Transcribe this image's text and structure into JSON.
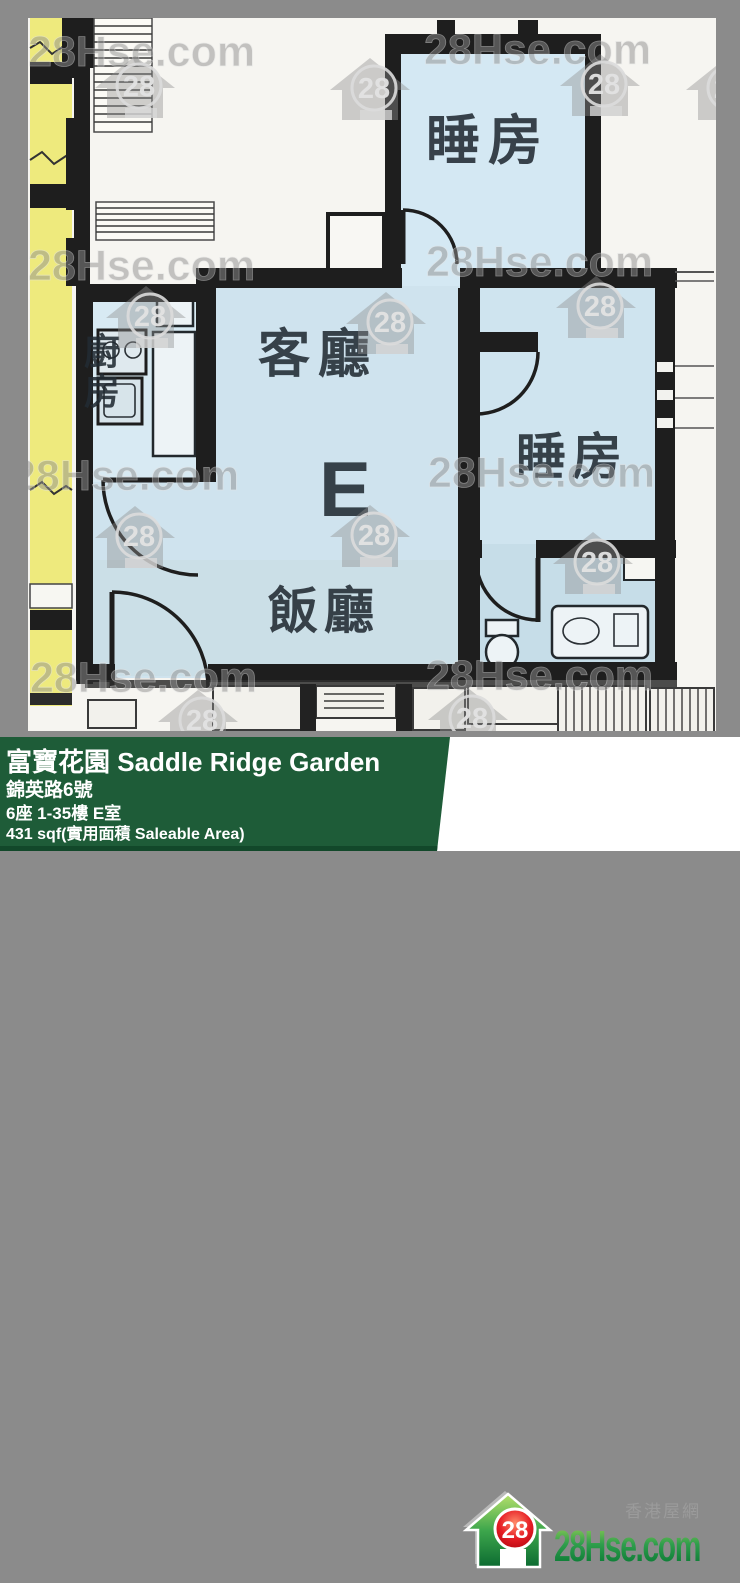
{
  "watermark": {
    "text": "28Hse.com",
    "badge": "28"
  },
  "plan": {
    "labels": {
      "bedroom_top": "睡房",
      "bedroom_right": "睡房",
      "living": "客廳",
      "dining": "飯廳",
      "kitchen_top": "廚",
      "kitchen_bottom": "房",
      "unit_letter": "E"
    },
    "colors": {
      "room_blue": "#cfe3ee",
      "neighbor_yellow": "#eeea7d",
      "wall_black": "#1e1e1e"
    }
  },
  "footer": {
    "title": "富寶花園 Saddle Ridge Garden",
    "address": "錦英路6號",
    "unit": "6座 1-35樓 E室",
    "area": "431 sqf(實用面積 Saleable Area)"
  },
  "brand": {
    "cn_name": "香港屋網",
    "logo_text": "28Hse.com",
    "badge": "28",
    "colors": {
      "bar_green": "#1e5c38",
      "logo_green": "#00833e",
      "badge_red": "#e30613"
    }
  }
}
